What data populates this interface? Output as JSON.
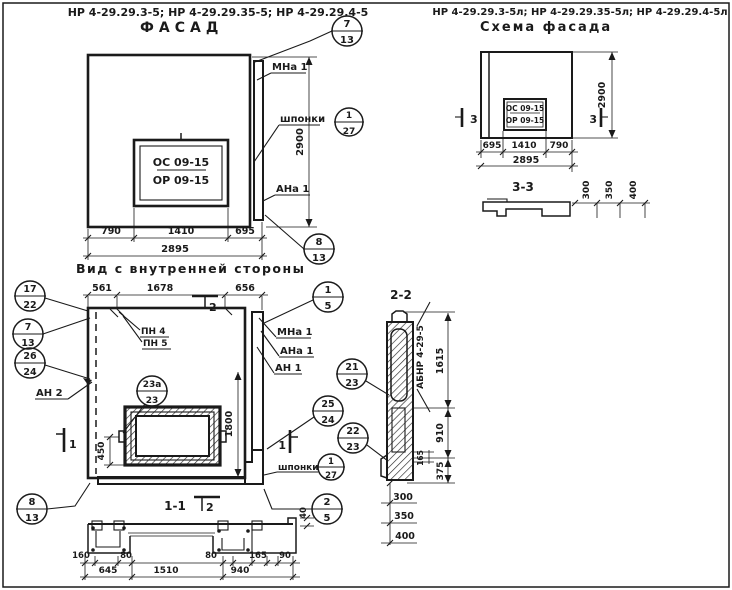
{
  "facade": {
    "title": "НР 4-29.29.3-5; НР 4-29.29.35-5; НР 4-29.29.4-5",
    "subtitle": "ФАСАД",
    "mark1": "ОС 09-15",
    "mark2": "ОР 09-15",
    "labels": {
      "mna1": "МНа 1",
      "shponki": "шпонки",
      "ana1": "АНа 1"
    },
    "dims": {
      "d790": "790",
      "d1410": "1410",
      "d695": "695",
      "d2895": "2895",
      "d2900": "2900"
    },
    "callouts": {
      "c7_13": {
        "t": "7",
        "b": "13"
      },
      "c1_27": {
        "t": "1",
        "b": "27"
      },
      "c8_13": {
        "t": "8",
        "b": "13"
      }
    }
  },
  "schema": {
    "title": "НР 4-29.29.3-5л; НР 4-29.29.35-5л; НР 4-29.29.4-5л",
    "subtitle": "Схема фасада",
    "mark1": "ОС 09-15",
    "mark2": "ОР 09-15",
    "section_mark": "3",
    "section_title": "3-3",
    "dims": {
      "d695": "695",
      "d1410": "1410",
      "d790": "790",
      "d2895": "2895",
      "d2900": "2900",
      "d300": "300",
      "d350": "350",
      "d400": "400"
    }
  },
  "interior": {
    "title": "Вид с внутренней стороны",
    "marker1": "1",
    "marker2": "2",
    "labels": {
      "pn4": "ПН 4",
      "pn5": "ПН 5",
      "mna1": "МНа 1",
      "ana1": "АНа 1",
      "an1": "АН 1",
      "an2": "АН 2",
      "shponki": "шпонки"
    },
    "dims": {
      "d561": "561",
      "d1678": "1678",
      "d656": "656",
      "d450": "450",
      "d1800": "1800"
    },
    "callouts": {
      "c17_22": {
        "t": "17",
        "b": "22"
      },
      "c7_13": {
        "t": "7",
        "b": "13"
      },
      "c26_24": {
        "t": "26",
        "b": "24"
      },
      "c23a_23": {
        "t": "23а",
        "b": "23"
      },
      "c1_5": {
        "t": "1",
        "b": "5"
      },
      "c21_23": {
        "t": "21",
        "b": "23"
      },
      "c25_24": {
        "t": "25",
        "b": "24"
      },
      "c22_23": {
        "t": "22",
        "b": "23"
      },
      "c1_27": {
        "t": "1",
        "b": "27"
      },
      "c2_5": {
        "t": "2",
        "b": "5"
      },
      "c8_13": {
        "t": "8",
        "b": "13"
      }
    },
    "section": {
      "title": "1-1",
      "dims": {
        "d160": "160",
        "d80a": "80",
        "d80b": "80",
        "d165": "165",
        "d90": "90",
        "d645": "645",
        "d1510": "1510",
        "d940": "940",
        "d40": "40"
      }
    }
  },
  "section22": {
    "title": "2-2",
    "label": "АБНР 4-29-5",
    "dims": {
      "d1615": "1615",
      "d910": "910",
      "d165": "165",
      "d375": "375",
      "d300": "300",
      "d350": "350",
      "d400": "400"
    }
  }
}
